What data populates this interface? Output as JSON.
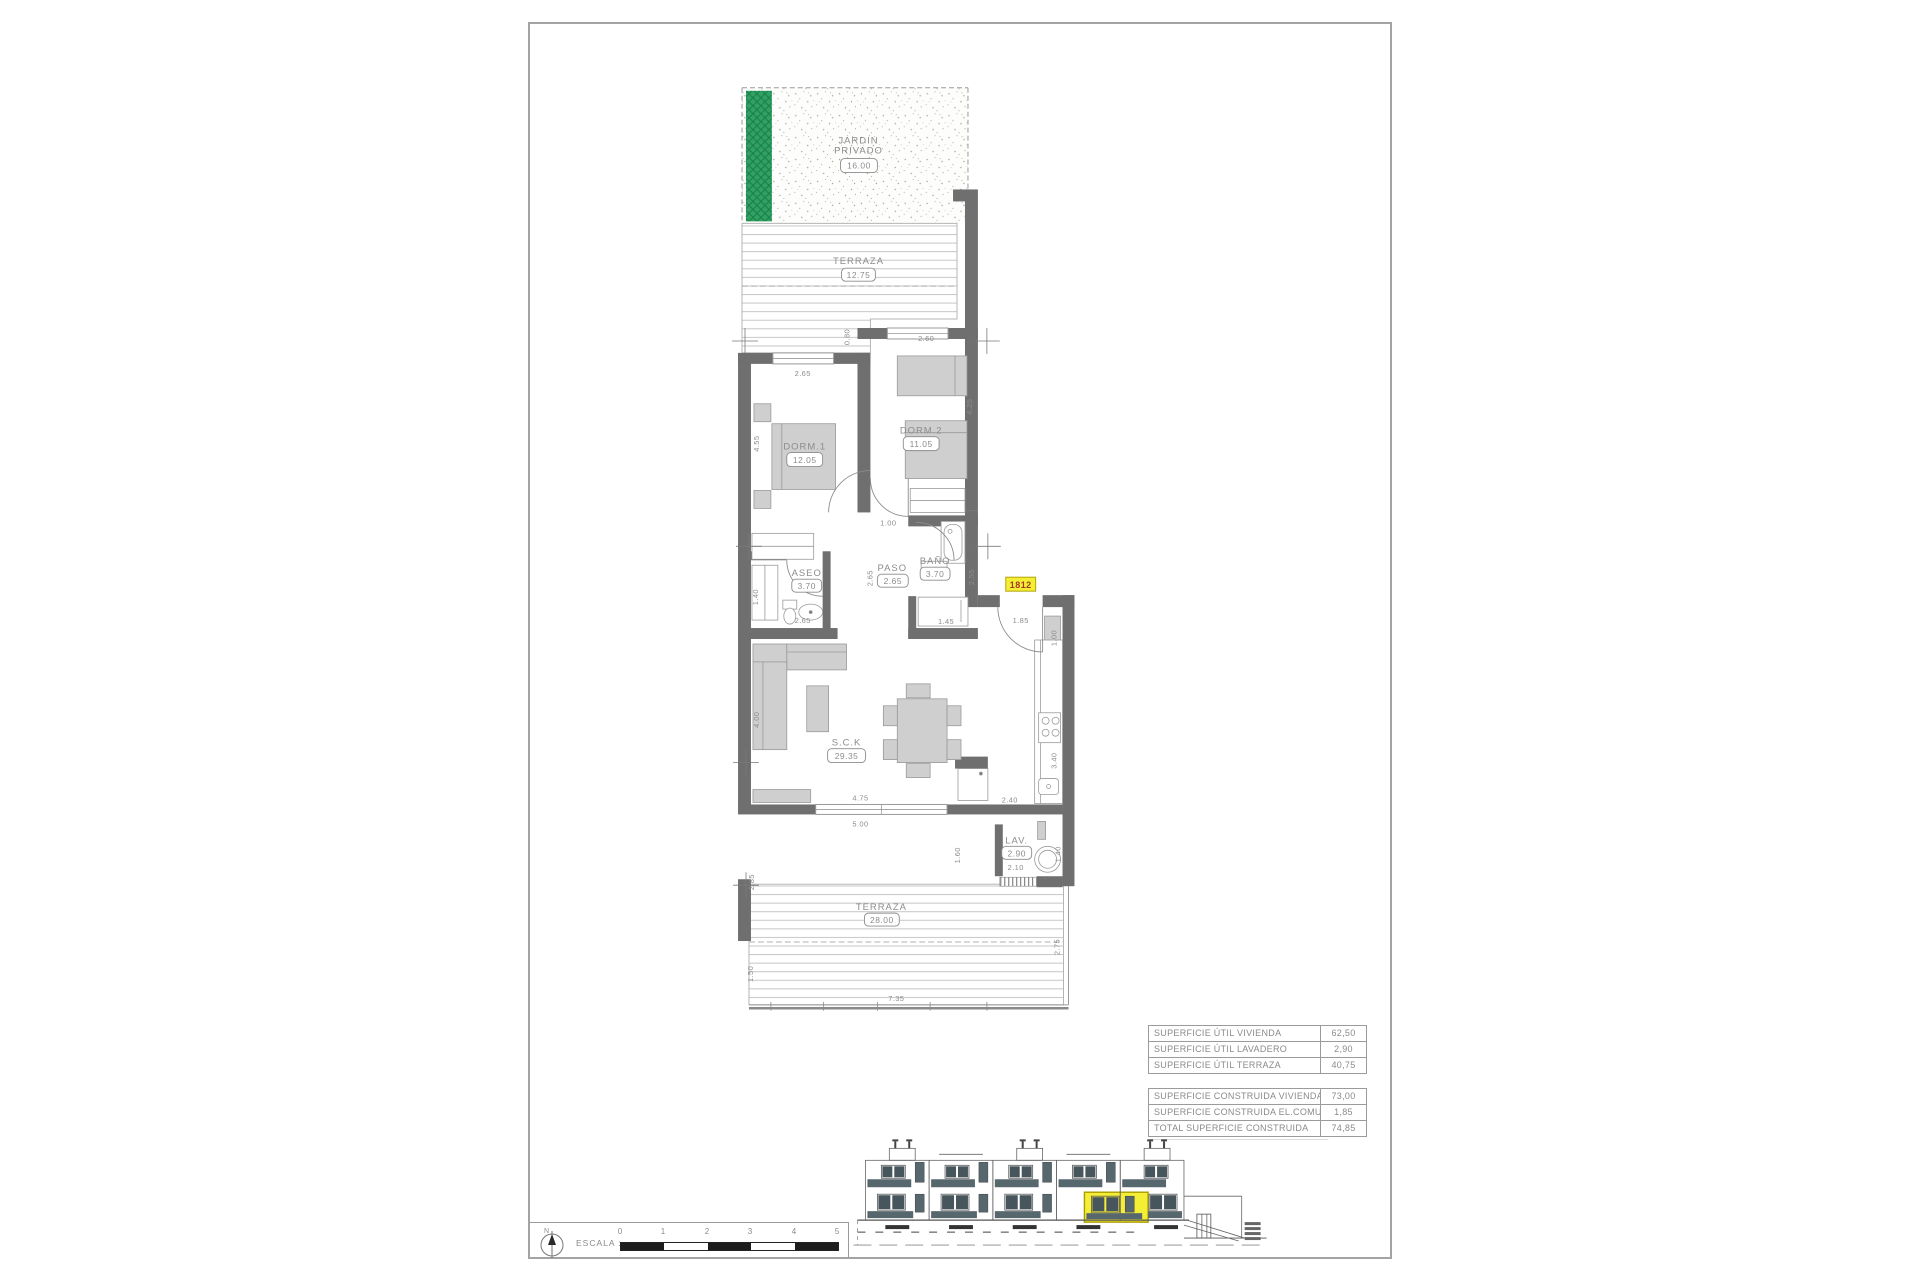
{
  "colors": {
    "wall_gray": "#6f6f6f",
    "furniture_gray": "#cfcfcf",
    "garden_green": "#2fa263",
    "highlight_yellow": "#f4ee34",
    "tag_text_red": "#a13a22",
    "drawing_text_gray": "#8c8c8c",
    "elevation_band": "#57676e"
  },
  "plan": {
    "garden": {
      "l1": "JARDIN",
      "l2": "PRIVADO",
      "area": "16.00"
    },
    "terr_top": {
      "label": "TERRAZA",
      "area": "12.75"
    },
    "dorm1": {
      "label": "DORM.1",
      "area": "12.05"
    },
    "dorm2": {
      "label": "DORM.2",
      "area": "11.05"
    },
    "aseo": {
      "label": "ASEO",
      "area": "3.70"
    },
    "paso": {
      "label": "PASO",
      "area": "2.65"
    },
    "bano": {
      "label": "BAÑO",
      "area": "3.70"
    },
    "sck": {
      "label": "S.C.K",
      "area": "29.35"
    },
    "lav": {
      "label": "LAV.",
      "area": "2.90"
    },
    "terr_bottom": {
      "label": "TERRAZA",
      "area": "28.00"
    },
    "tag": "1812",
    "dims": {
      "dorm1_w": "2.65",
      "dorm2_w": "2.60",
      "terr_r": "0.80",
      "dorm1_h": "4.55",
      "dorm2_h": "4.25",
      "hall": "1.00",
      "paso_v": "2.65",
      "bano_r": "2.55",
      "bano_b": "1.45",
      "aseo_b": "2.65",
      "aseo_l": "1.40",
      "entry": "1.85",
      "entry_v": "1.00",
      "sck_l": "4.00",
      "win_in": "4.75",
      "win_out": "5.00",
      "kitchen": "2.40",
      "kitchen_v": "3.40",
      "lav_b": "2.10",
      "lav_r": "1.40",
      "terr2_r1": "1.60",
      "terr2_l1": "2.85",
      "terr2_l2": "1.50",
      "terr2_r2": "2.75",
      "terr2_b": "7.35"
    }
  },
  "tables": {
    "util": [
      {
        "label": "SUPERFICIE ÚTIL VIVIENDA",
        "value": "62,50"
      },
      {
        "label": "SUPERFICIE ÚTIL LAVADERO",
        "value": "2,90"
      },
      {
        "label": "SUPERFICIE ÚTIL TERRAZA",
        "value": "40,75"
      }
    ],
    "construida": [
      {
        "label": "SUPERFICIE CONSTRUIDA VIVIENDA",
        "value": "73,00"
      },
      {
        "label": "SUPERFICIE CONSTRUIDA EL.COMUNES",
        "value": "1,85"
      },
      {
        "label": "TOTAL SUPERFICIE CONSTRUIDA",
        "value": "74,85"
      }
    ]
  },
  "scale_box": {
    "escala": "ESCALA :",
    "north": "N",
    "ticks": [
      "0",
      "1",
      "2",
      "3",
      "4",
      "5"
    ]
  }
}
